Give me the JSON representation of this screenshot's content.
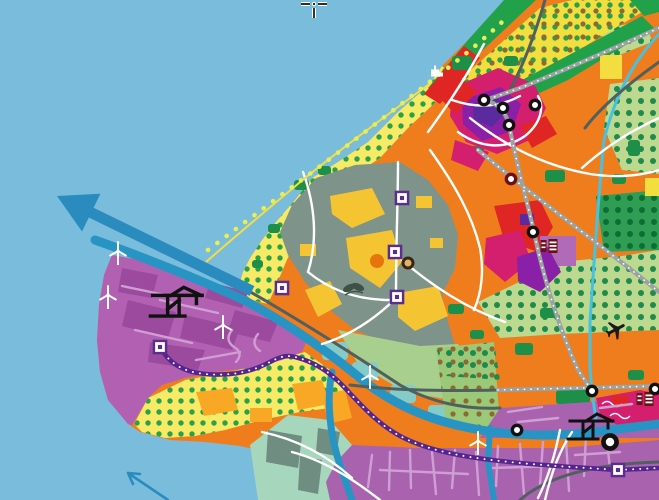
{
  "map": {
    "kind": "stylized coastal land-use planning map",
    "layers": [
      "sea",
      "coastal-beach",
      "dune-strip",
      "greenhouse-district",
      "urban-area",
      "port",
      "harbor-band",
      "canals",
      "railways",
      "roads",
      "dotted-route"
    ]
  },
  "palette": {
    "water": "#79bcdb",
    "arrow_blue": "#2a8cbe",
    "canal_blue": "#2794c4",
    "canal_cyan": "#45c2e2",
    "port_purple": "#b261b2",
    "port_block": "#9c4a9e",
    "harbor_purple": "#a963ae",
    "street_lilac": "#cf9fd4",
    "route_purple": "#55258f",
    "marker_purple": "#5b2d8e",
    "urban_orange": "#ef7d1e",
    "orange_blob": "#f9a826",
    "red": "#e02525",
    "crimson": "#d41f6e",
    "city_purple": "#8a1fa8",
    "indigo": "#5a2a9e",
    "green": "#21a14a",
    "green_dark": "#1d8f48",
    "green_light": "#bcd98f",
    "mint": "#a6d6bb",
    "slate_green": "#6f8d80",
    "sage": "#7e9389",
    "yellow": "#f2df3f",
    "beach_yellow": "#f6ea67",
    "gold": "#f5c433",
    "dot_green": "#2aa04a",
    "dot_brown": "#8a6a35",
    "line_yellow": "#e6ef58",
    "maroon": "#6d1016",
    "rail_gray": "#9aa2a2",
    "road_dark": "#50605e",
    "white": "#ffffff"
  },
  "icons": {
    "wind_turbines": [
      {
        "x": 118,
        "y": 253
      },
      {
        "x": 108,
        "y": 297
      },
      {
        "x": 223,
        "y": 327
      },
      {
        "x": 370,
        "y": 377
      },
      {
        "x": 478,
        "y": 443
      }
    ],
    "container_cranes": [
      {
        "x": 178,
        "y": 308,
        "s": 1.15
      },
      {
        "x": 592,
        "y": 432,
        "s": 1.0
      }
    ],
    "rail_stations": [
      {
        "x": 484,
        "y": 100,
        "v": "black"
      },
      {
        "x": 503,
        "y": 108,
        "v": "black"
      },
      {
        "x": 509,
        "y": 125,
        "v": "black"
      },
      {
        "x": 535,
        "y": 105,
        "v": "black"
      },
      {
        "x": 533,
        "y": 232,
        "v": "black"
      },
      {
        "x": 592,
        "y": 391,
        "v": "black"
      },
      {
        "x": 655,
        "y": 389,
        "v": "black"
      },
      {
        "x": 517,
        "y": 430,
        "v": "black"
      },
      {
        "x": 610,
        "y": 442,
        "v": "black",
        "large": true
      },
      {
        "x": 511,
        "y": 179,
        "v": "maroon"
      }
    ],
    "area_markers": [
      {
        "x": 402,
        "y": 198
      },
      {
        "x": 395,
        "y": 252
      },
      {
        "x": 397,
        "y": 297
      },
      {
        "x": 282,
        "y": 288
      },
      {
        "x": 160,
        "y": 347
      },
      {
        "x": 618,
        "y": 470
      }
    ],
    "greenhouse_glyphs": [
      {
        "x": 549,
        "y": 246
      },
      {
        "x": 645,
        "y": 399
      }
    ],
    "airplane": {
      "x": 616,
      "y": 330,
      "rotation": 62
    },
    "leaf": {
      "x": 343,
      "y": 279
    },
    "orange_disc": {
      "x": 377,
      "y": 261
    },
    "ringed_disc_tan": {
      "x": 408,
      "y": 263
    },
    "coast_building": {
      "x": 431,
      "y": 66
    },
    "cursor": {
      "x": 314,
      "y": 4
    }
  },
  "annotations": {
    "sea_arrow_large": {
      "tip": {
        "x": 57,
        "y": 196
      },
      "tail": {
        "x": 252,
        "y": 291
      }
    },
    "sea_arrow_small": {
      "tip": {
        "x": 128,
        "y": 473
      },
      "tail": {
        "x": 168,
        "y": 500
      }
    }
  }
}
